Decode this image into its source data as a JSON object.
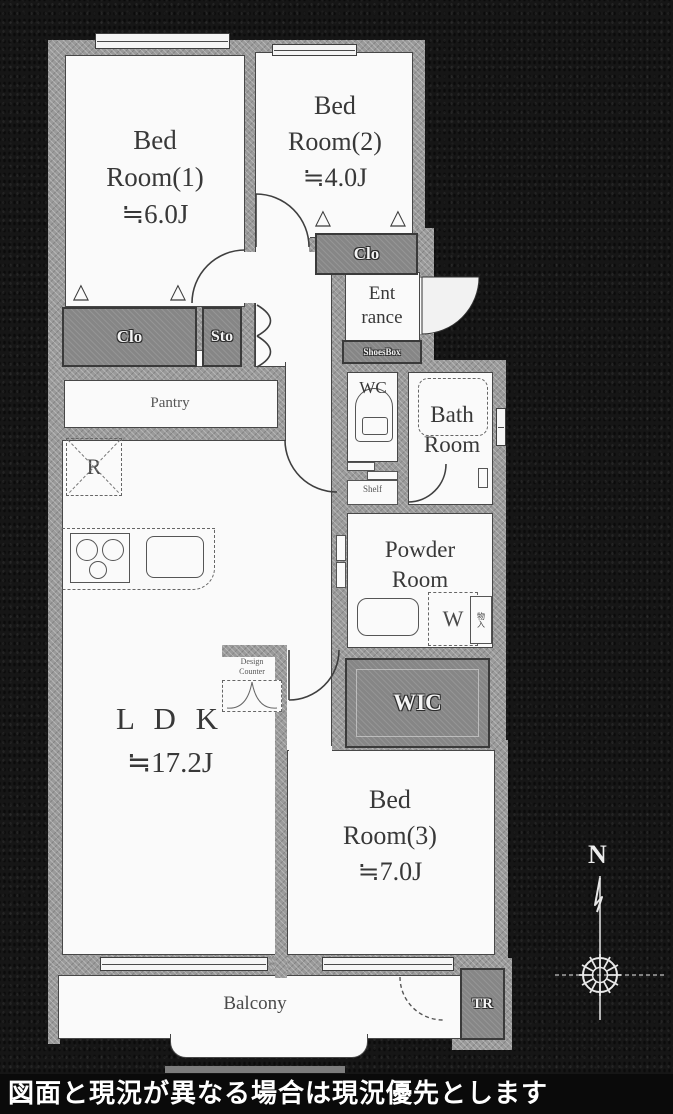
{
  "footer": {
    "disclaimer": "図面と現況が異なる場合は現況優先とします"
  },
  "compass": {
    "north": "N"
  },
  "rooms": {
    "bed1": {
      "name_l1": "Bed",
      "name_l2": "Room(1)",
      "area": "≒6.0J"
    },
    "bed2": {
      "name_l1": "Bed",
      "name_l2": "Room(2)",
      "area": "≒4.0J"
    },
    "bed3": {
      "name_l1": "Bed",
      "name_l2": "Room(3)",
      "area": "≒7.0J"
    },
    "ldk": {
      "name": "L D K",
      "area": "≒17.2J"
    },
    "entrance": {
      "name_l1": "Ent",
      "name_l2": "rance"
    },
    "powder_room": {
      "name_l1": "Powder",
      "name_l2": "Room"
    },
    "bath_room": {
      "name_l1": "Bath",
      "name_l2": "Room"
    },
    "wc": {
      "name": "WC"
    },
    "pantry": {
      "name": "Pantry"
    },
    "balcony": {
      "name": "Balcony"
    }
  },
  "storage": {
    "closet_bed1": "Clo",
    "storage_hall": "Sto",
    "closet_bed2": "Clo",
    "walk_in_closet": "WIC",
    "trunk_room": "TR",
    "shoes_box": "ShoesBox",
    "shelf": "Shelf",
    "cabinet": "物入"
  },
  "fixtures": {
    "refrigerator": "R",
    "washing_machine": "W",
    "design_counter_l1": "Design",
    "design_counter_l2": "Counter"
  },
  "icons": {
    "fold_door": "△"
  },
  "colors": {
    "wall": "#9a9a9a",
    "storage_fill": "#868686",
    "background": "#161616",
    "label_text": "#383838"
  }
}
